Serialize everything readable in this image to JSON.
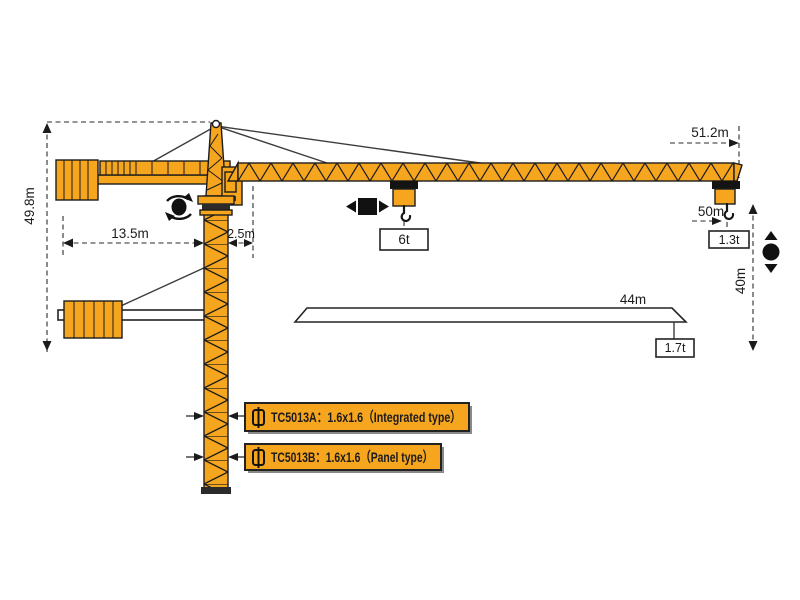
{
  "page": {
    "background": "#ffffff"
  },
  "dimensions": {
    "total_height": "49.8m",
    "counter_jib_length": "13.5m",
    "tower_offset": "2.5m",
    "jib_tip_radius": "51.2m",
    "max_radius": "50m",
    "under_hook_height": "40m",
    "short_jib_length": "44m"
  },
  "loads": {
    "max_capacity": "6t",
    "tip_load_long_jib": "1.3t",
    "tip_load_short_jib": "1.7t"
  },
  "models": {
    "integrated": "TC5013A：1.6x1.6（Integrated type）",
    "panel": "TC5013B：1.6x1.6（Panel type）"
  },
  "colors": {
    "crane_orange": "#F6A51F",
    "outline": "#1C1C1C",
    "dimension_lines": "#2B2B2B",
    "label_box": "#F6A51F"
  },
  "icons": {
    "slewing": "rotation-arrows-around-dot",
    "trolley_travel": "left-right-arrows-square",
    "hoisting": "up-down-arrows-dot",
    "mast_section": "rectangle-with-vertical-axis-line"
  }
}
